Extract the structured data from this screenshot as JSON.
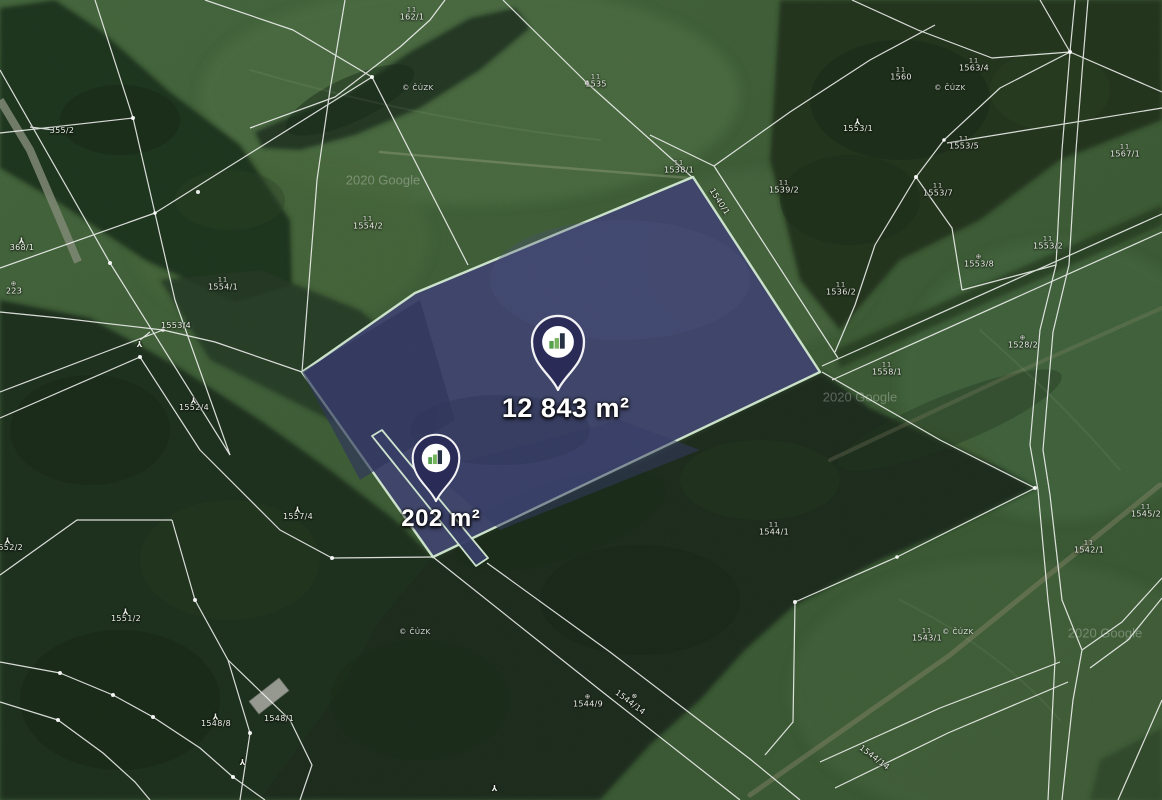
{
  "map_view": {
    "attribution": "2020 Google",
    "cadastre_stamp": "© ČÚZK"
  },
  "parcels": {
    "highlighted": [
      {
        "name": "main-parcel",
        "area_label": "12 843 m²"
      },
      {
        "name": "strip-parcel",
        "area_label": "202 m²"
      }
    ]
  },
  "markers": [
    {
      "id": "marker-large",
      "label": "12 843 m²",
      "x": 558,
      "y": 390
    },
    {
      "id": "marker-small",
      "label": "202 m²",
      "x": 436,
      "y": 502
    }
  ],
  "parcel_numbers": [
    {
      "text": "355/2",
      "x": 62,
      "y": 131
    },
    {
      "text": "368/1",
      "x": 22,
      "y": 244,
      "sym": "tree"
    },
    {
      "text": "223",
      "x": 14,
      "y": 288,
      "sym": "circle"
    },
    {
      "text": "1554/1",
      "x": 223,
      "y": 284,
      "sym": "meadow"
    },
    {
      "text": "1554/2",
      "x": 368,
      "y": 223,
      "sym": "meadow"
    },
    {
      "text": "162/1",
      "x": 412,
      "y": 14,
      "sym": "meadow"
    },
    {
      "text": "1535",
      "x": 596,
      "y": 81,
      "sym": "meadow"
    },
    {
      "text": "1538/1",
      "x": 679,
      "y": 167,
      "sym": "meadow"
    },
    {
      "text": "1540/1",
      "x": 719,
      "y": 202,
      "rot": 57
    },
    {
      "text": "1539/2",
      "x": 784,
      "y": 187,
      "sym": "meadow"
    },
    {
      "text": "1560",
      "x": 901,
      "y": 74,
      "sym": "meadow"
    },
    {
      "text": "1563/4",
      "x": 974,
      "y": 65,
      "sym": "meadow"
    },
    {
      "text": "1553/1",
      "x": 858,
      "y": 125,
      "sym": "tree"
    },
    {
      "text": "1553/5",
      "x": 964,
      "y": 143,
      "sym": "meadow"
    },
    {
      "text": "1553/7",
      "x": 938,
      "y": 190,
      "sym": "meadow"
    },
    {
      "text": "1567/1",
      "x": 1125,
      "y": 151,
      "sym": "meadow"
    },
    {
      "text": "1536/2",
      "x": 841,
      "y": 289,
      "sym": "meadow"
    },
    {
      "text": "1553/8",
      "x": 979,
      "y": 261,
      "sym": "circle"
    },
    {
      "text": "1553/2",
      "x": 1048,
      "y": 243,
      "sym": "meadow"
    },
    {
      "text": "1528/2",
      "x": 1023,
      "y": 342,
      "sym": "circle"
    },
    {
      "text": "1558/1",
      "x": 887,
      "y": 369,
      "sym": "meadow"
    },
    {
      "text": "1544/1",
      "x": 774,
      "y": 529,
      "sym": "meadow"
    },
    {
      "text": "1545/2",
      "x": 1146,
      "y": 511,
      "sym": "meadow"
    },
    {
      "text": "1542/1",
      "x": 1089,
      "y": 547,
      "sym": "meadow"
    },
    {
      "text": "1543/1",
      "x": 927,
      "y": 635,
      "sym": "meadow"
    },
    {
      "text": "1544/9",
      "x": 588,
      "y": 701,
      "sym": "circle"
    },
    {
      "text": "1544/14",
      "x": 632,
      "y": 700,
      "rot": 37,
      "sym": "circle"
    },
    {
      "text": "1544/14",
      "x": 874,
      "y": 758,
      "rot": 37
    },
    {
      "text": "1557/4",
      "x": 298,
      "y": 513,
      "sym": "tree"
    },
    {
      "text": "1553/4",
      "x": 176,
      "y": 326
    },
    {
      "text": "1552/4",
      "x": 194,
      "y": 404,
      "sym": "tree"
    },
    {
      "text": "1552/2",
      "x": 8,
      "y": 544,
      "sym": "tree"
    },
    {
      "text": "1551/2",
      "x": 126,
      "y": 615,
      "sym": "tree"
    },
    {
      "text": "1548/8",
      "x": 216,
      "y": 720,
      "sym": "tree"
    },
    {
      "text": "1548/1",
      "x": 279,
      "y": 719
    },
    {
      "text": "",
      "x": 243,
      "y": 761,
      "sym": "tree"
    },
    {
      "text": "",
      "x": 495,
      "y": 787,
      "sym": "tree"
    },
    {
      "text": "",
      "x": 140,
      "y": 343,
      "sym": "tree"
    }
  ],
  "stamps": [
    {
      "x": 418,
      "y": 88
    },
    {
      "x": 950,
      "y": 88
    },
    {
      "x": 415,
      "y": 632
    },
    {
      "x": 958,
      "y": 632
    }
  ],
  "watermarks": [
    {
      "x": 383,
      "y": 180
    },
    {
      "x": 860,
      "y": 397
    },
    {
      "x": 1105,
      "y": 633
    }
  ],
  "colors": {
    "highlight_fill": "#3d4268",
    "highlight_stroke": "#cfe7cf",
    "pin_body": "#2b2b58",
    "field_green": "#3a5733",
    "forest_green": "#1f301d"
  }
}
